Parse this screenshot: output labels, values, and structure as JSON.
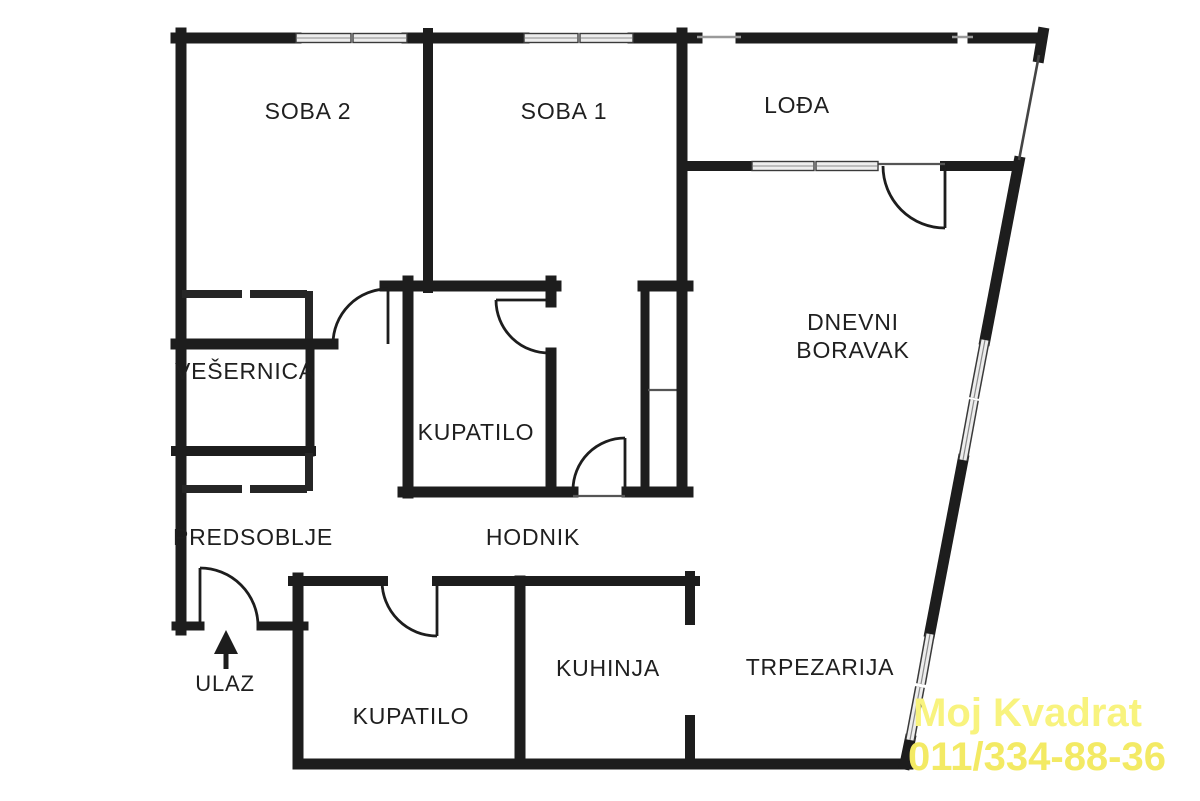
{
  "meta": {
    "type": "apartment-floor-plan"
  },
  "plan": {
    "wall_color": "#1d1d1d",
    "background": "#ffffff",
    "labels": [
      {
        "id": "soba2",
        "text": "SOBA 2"
      },
      {
        "id": "soba1",
        "text": "SOBA 1"
      },
      {
        "id": "lodja",
        "text": "LOĐA"
      },
      {
        "id": "dnevni",
        "text": "DNEVNI"
      },
      {
        "id": "boravak",
        "text": "BORAVAK"
      },
      {
        "id": "vesernica",
        "text": "VEŠERNICA"
      },
      {
        "id": "kupatilo-upper",
        "text": "KUPATILO"
      },
      {
        "id": "predsoblje",
        "text": "PREDSOBLJE"
      },
      {
        "id": "hodnik",
        "text": "HODNIK"
      },
      {
        "id": "ulaz",
        "text": "ULAZ"
      },
      {
        "id": "kupatilo-lower",
        "text": "KUPATILO"
      },
      {
        "id": "kuhinja",
        "text": "KUHINJA"
      },
      {
        "id": "trpezarija",
        "text": "TRPEZARIJA"
      }
    ]
  },
  "watermark": {
    "line1": "Moj Kvadrat",
    "line2": "011/334-88-36",
    "color_line1": "#f8f37e",
    "color_line2": "#f3ea64"
  }
}
